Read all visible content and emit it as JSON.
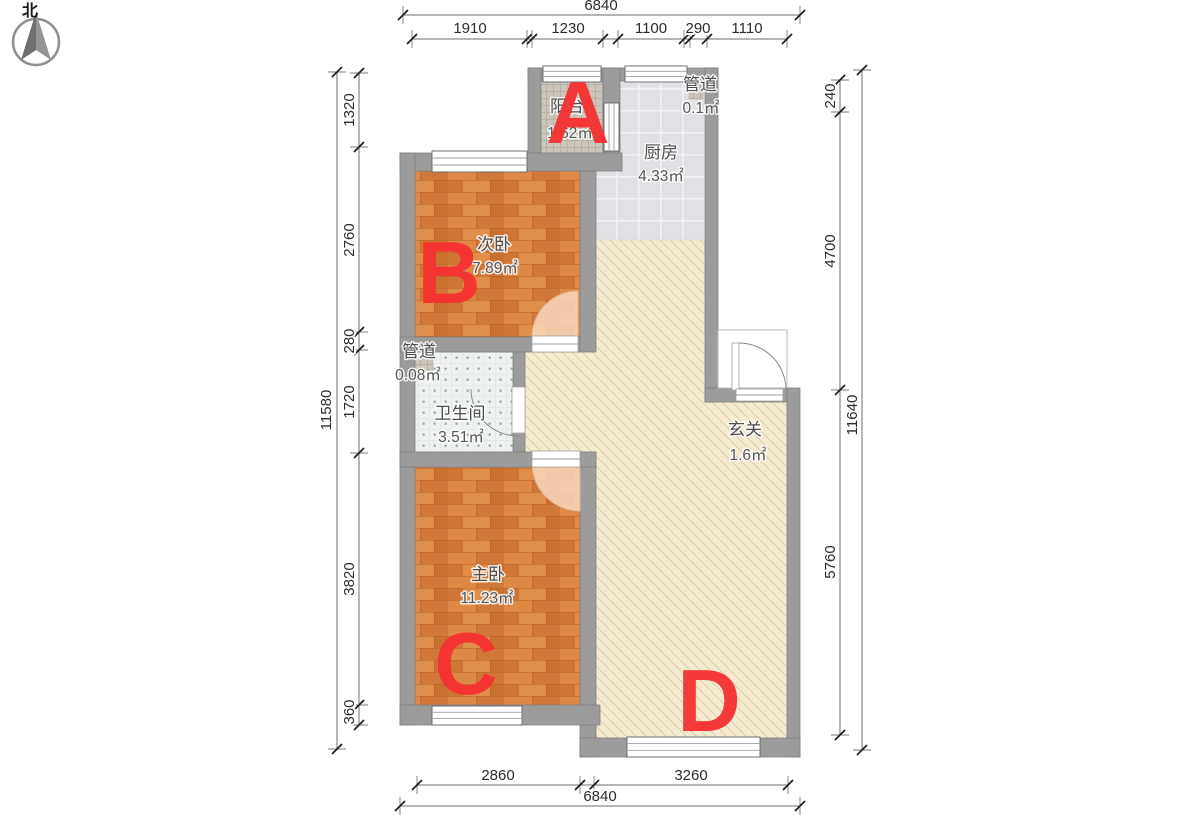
{
  "compass": {
    "north": "北"
  },
  "rooms": {
    "balcony": {
      "name": "阳台",
      "area": "1.62㎡",
      "letter": "A"
    },
    "duct_kitchen": {
      "name": "管道",
      "area": "0.1㎡"
    },
    "kitchen": {
      "name": "厨房",
      "area": "4.33㎡"
    },
    "bedroom_second": {
      "name": "次卧",
      "area": "7.89㎡",
      "letter": "B"
    },
    "duct_bath": {
      "name": "管道",
      "area": "0.08㎡"
    },
    "bathroom": {
      "name": "卫生间",
      "area": "3.51㎡"
    },
    "bedroom_master": {
      "name": "主卧",
      "area": "11.23㎡",
      "letter": "C"
    },
    "foyer": {
      "name": "玄关",
      "area": "1.6㎡"
    },
    "living": {
      "letter": "D"
    }
  },
  "dimensions": {
    "top": {
      "total": "6840",
      "segments": [
        "1910",
        "1230",
        "1100",
        "290",
        "1110"
      ]
    },
    "left": {
      "total": "11580",
      "segments": [
        "1320",
        "2760",
        "280",
        "1720",
        "3820",
        "360"
      ]
    },
    "right": {
      "total": "11640",
      "segments": [
        "240",
        "4700",
        "5760"
      ]
    },
    "bottom": {
      "total": "6840",
      "segments": [
        "2860",
        "3260"
      ]
    }
  },
  "colors": {
    "letter_red": "#f73131",
    "wall_gray": "#9c9c9c",
    "wood_floor": "#d8823f",
    "living_cream": "#f5ebd1",
    "kitchen_tile": "#e0e0e5",
    "dimension_text": "#2b2b2b"
  }
}
